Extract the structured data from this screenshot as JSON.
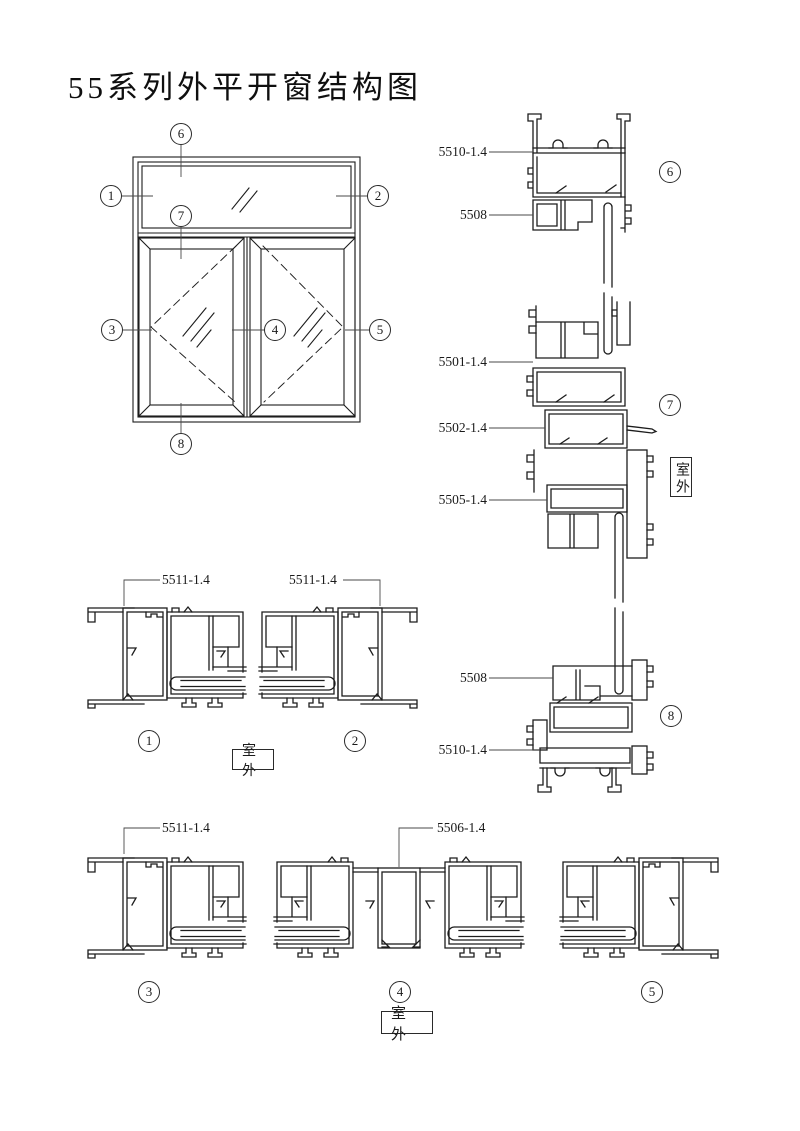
{
  "title": "55系列外平开窗结构图",
  "outdoor_label": "室外",
  "callout_numbers": [
    "1",
    "2",
    "3",
    "4",
    "5",
    "6",
    "7",
    "8"
  ],
  "part_labels": {
    "head_frame": "5510-1.4",
    "head_bead": "5508",
    "upper_sash_top": "5501-1.4",
    "transom": "5502-1.4",
    "lower_sash_top": "5505-1.4",
    "sill_bead": "5508",
    "sill_frame": "5510-1.4",
    "jamb_section1": "5511-1.4",
    "jamb_section2": "5511-1.4",
    "jamb_section3": "5511-1.4",
    "mullion": "5506-1.4"
  }
}
